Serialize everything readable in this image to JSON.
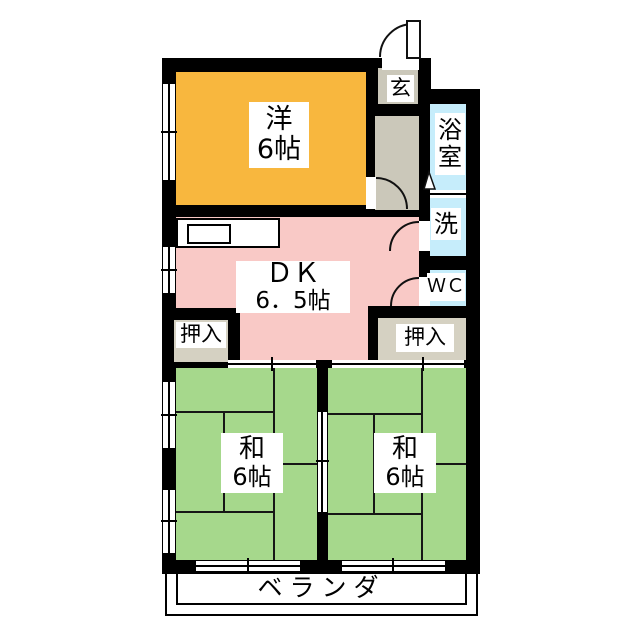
{
  "plan": {
    "type": "apartment-floor-plan",
    "rooms": {
      "western_room": {
        "name_line1": "洋",
        "name_line2": "6帖",
        "color": "#F8B73E"
      },
      "dining_kitchen": {
        "name_line1": "ＤＫ",
        "name_line2": "6．5帖",
        "color": "#F9C9C6"
      },
      "japanese_room_left": {
        "name_line1": "和",
        "name_line2": "6帖",
        "color": "#A6D88C"
      },
      "japanese_room_right": {
        "name_line1": "和",
        "name_line2": "6帖",
        "color": "#A6D88C"
      },
      "bathroom": {
        "name_line1": "浴",
        "name_line2": "室",
        "color": "#C6EDFB"
      },
      "washroom": {
        "name": "洗",
        "color": "#C6EDFB"
      },
      "toilet": {
        "name": "ＷＣ",
        "color": "#C6EDFB"
      },
      "entrance": {
        "name": "玄",
        "color": "#CBC8BA"
      },
      "closet_left": {
        "name": "押入",
        "color": "#D5D1C2"
      },
      "closet_right": {
        "name": "押入",
        "color": "#D5D1C2"
      },
      "veranda": {
        "name": "ベランダ",
        "color": "#FFFFFF"
      }
    },
    "colors": {
      "wall": "#000000",
      "hallway": "#CBC8BA",
      "water_area": "#C6EDFB",
      "tatami_green": "#A6D88C",
      "background": "#FFFFFF"
    }
  }
}
